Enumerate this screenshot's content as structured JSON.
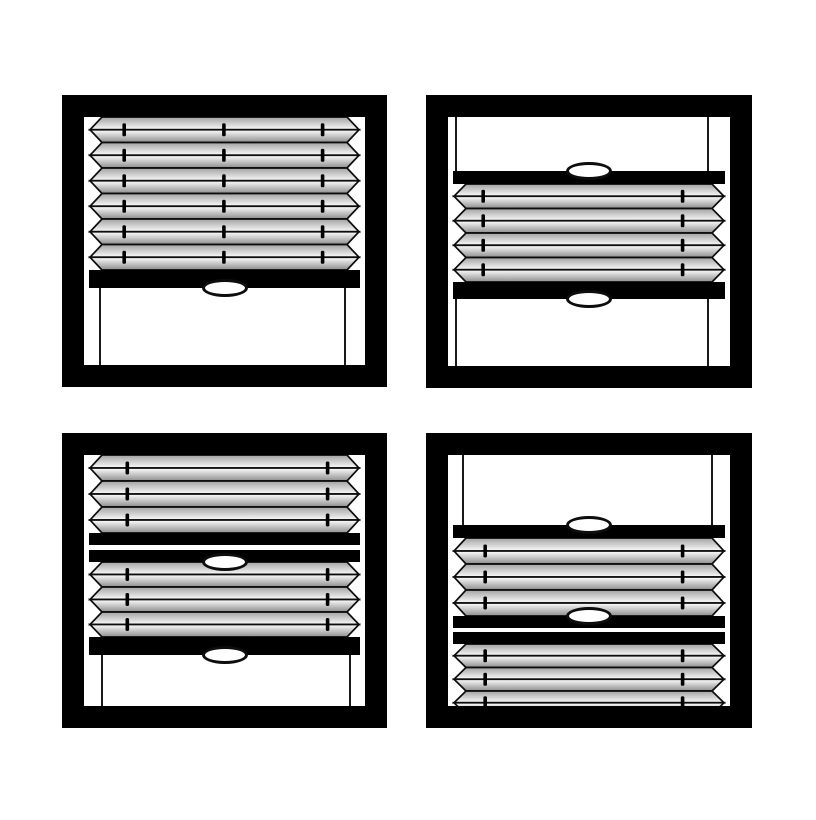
{
  "page": {
    "background": "#ffffff",
    "description": "four-window pleated blind position diagram"
  },
  "colors": {
    "frame": "#000000",
    "rail": "#000000",
    "outline": "#0d0d0d",
    "cord": "#1a1a1a",
    "tick": "#000000",
    "handle_fill": "#ffffff",
    "pleat_gradient_top": [
      "#a2a2a2",
      "#fbfbfb"
    ],
    "pleat_gradient_bottom": [
      "#ffffff",
      "#8d8d8d"
    ]
  },
  "layout": {
    "frame_border": 22,
    "rail_inset": 5,
    "pleat_inset": 6,
    "notch_depth": 12,
    "cord_width": 2,
    "tick": {
      "width": 3.6,
      "height": 13
    },
    "handle": {
      "width": 46,
      "height": 18,
      "border": 3.5
    }
  },
  "windows": [
    {
      "name": "top-left",
      "x": 62,
      "y": 95,
      "w": 325,
      "h": 292,
      "tick_columns": [
        0.143,
        0.498,
        0.849
      ],
      "cord_columns": [
        0.057,
        0.929
      ],
      "segments": [
        {
          "name": "fabric-panel",
          "type": "pleats",
          "y": 0,
          "count": 6,
          "band_height": 25.5
        },
        {
          "name": "bottom-rail",
          "type": "rail",
          "y": 153,
          "height": 18,
          "handle": "below"
        },
        {
          "name": "lift-cords",
          "type": "cords",
          "y1": 171,
          "y2": 248
        }
      ]
    },
    {
      "name": "top-right",
      "x": 426,
      "y": 95,
      "w": 326,
      "h": 293,
      "tick_columns": [
        0.125,
        0.832
      ],
      "cord_columns": [
        0.028,
        0.922
      ],
      "segments": [
        {
          "name": "upper-cords",
          "type": "cords",
          "y1": 0,
          "y2": 54
        },
        {
          "name": "top-rail",
          "type": "rail",
          "y": 54,
          "height": 13,
          "handle": "above"
        },
        {
          "name": "fabric-panel",
          "type": "pleats",
          "y": 67,
          "count": 4,
          "band_height": 24.5
        },
        {
          "name": "bottom-rail",
          "type": "rail",
          "y": 165,
          "height": 17,
          "handle": "below"
        },
        {
          "name": "lower-cords",
          "type": "cords",
          "y1": 182,
          "y2": 249
        }
      ]
    },
    {
      "name": "bottom-left",
      "x": 62,
      "y": 433,
      "w": 325,
      "h": 295,
      "tick_columns": [
        0.154,
        0.867
      ],
      "cord_columns": [
        0.064,
        0.946
      ],
      "segments": [
        {
          "name": "upper-fabric-panel",
          "type": "pleats",
          "y": 0,
          "count": 3,
          "band_height": 26
        },
        {
          "name": "middle-rail-upper",
          "type": "rail",
          "y": 78,
          "height": 12,
          "handle": null
        },
        {
          "name": "middle-rail-lower",
          "type": "rail",
          "y": 95,
          "height": 12,
          "handle": "below"
        },
        {
          "name": "lower-fabric-panel",
          "type": "pleats",
          "y": 107,
          "count": 3,
          "band_height": 25
        },
        {
          "name": "bottom-rail",
          "type": "rail",
          "y": 182,
          "height": 18,
          "handle": "below"
        },
        {
          "name": "lift-cords",
          "type": "cords",
          "y1": 200,
          "y2": 251
        }
      ]
    },
    {
      "name": "bottom-right",
      "x": 426,
      "y": 433,
      "w": 326,
      "h": 295,
      "tick_columns": [
        0.132,
        0.832
      ],
      "cord_columns": [
        0.053,
        0.936
      ],
      "segments": [
        {
          "name": "upper-cords",
          "type": "cords",
          "y1": 0,
          "y2": 70
        },
        {
          "name": "top-rail",
          "type": "rail",
          "y": 70,
          "height": 13,
          "handle": "above"
        },
        {
          "name": "upper-fabric-panel",
          "type": "pleats",
          "y": 83,
          "count": 3,
          "band_height": 26
        },
        {
          "name": "middle-rail-upper",
          "type": "rail",
          "y": 161,
          "height": 12,
          "handle": "above"
        },
        {
          "name": "middle-rail-lower",
          "type": "rail",
          "y": 177,
          "height": 12,
          "handle": null
        },
        {
          "name": "lower-fabric-panel",
          "type": "pleats",
          "y": 189,
          "count": 3,
          "band_height": 23.5
        }
      ]
    }
  ]
}
